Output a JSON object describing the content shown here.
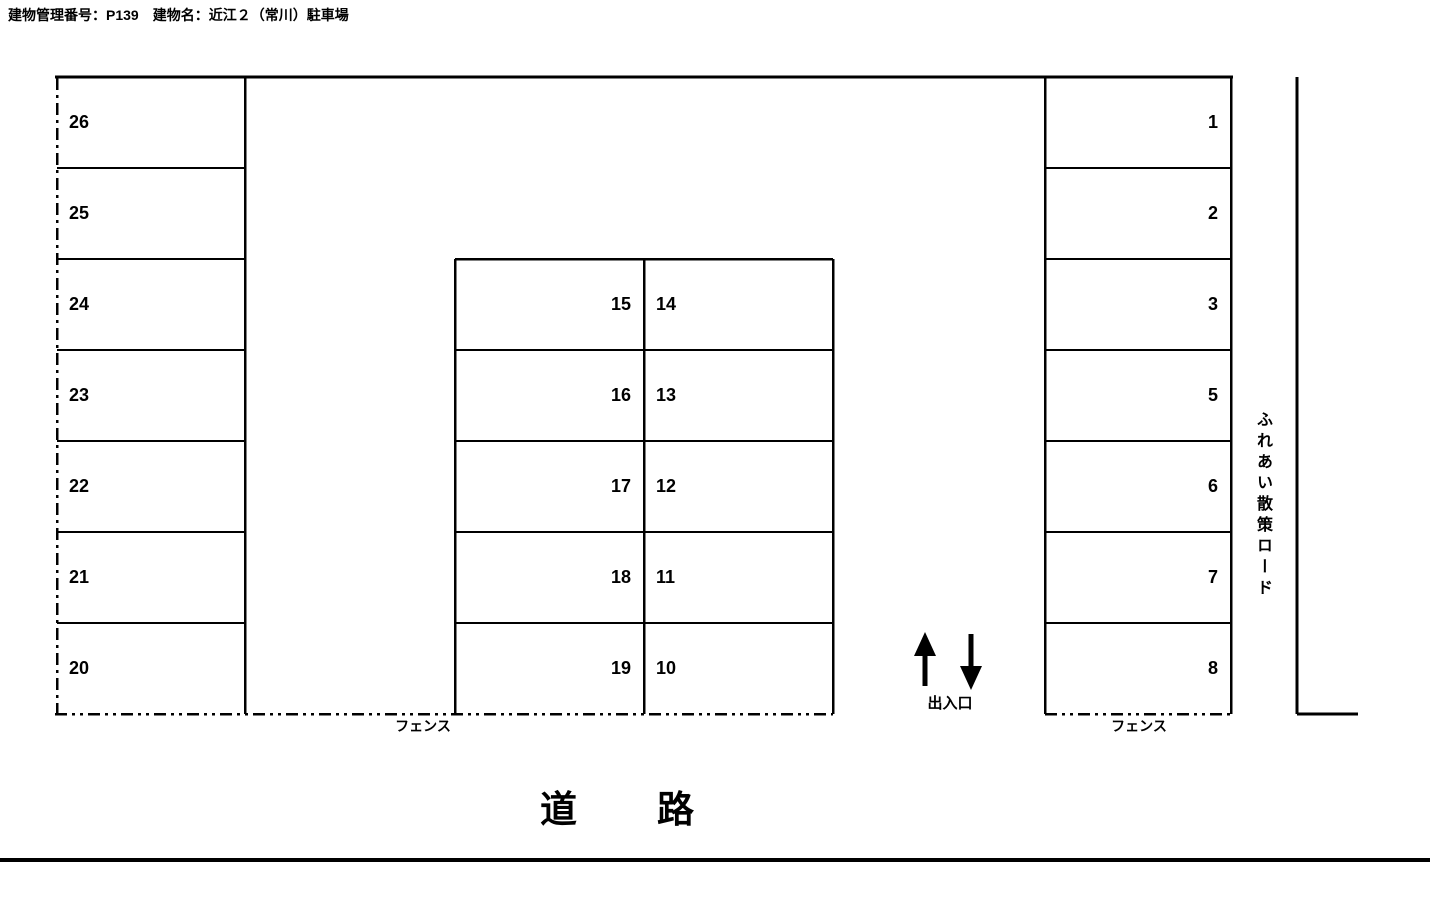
{
  "title": "建物管理番号：P139　建物名：近江２（常川）駐車場",
  "labels": {
    "fence_left": "フェンス",
    "fence_right": "フェンス",
    "entrance": "出入口",
    "road": "道　　路",
    "side_road": "ふれあい散策ロード"
  },
  "icons": {
    "entrance_up": "up-arrow",
    "entrance_down": "down-arrow"
  },
  "colors": {
    "line": "#000000",
    "text": "#000000",
    "background": "#ffffff"
  },
  "parking": {
    "left_column": [
      "26",
      "25",
      "24",
      "23",
      "22",
      "21",
      "20"
    ],
    "middle_left_column": [
      "15",
      "16",
      "17",
      "18",
      "19"
    ],
    "middle_right_column": [
      "14",
      "13",
      "12",
      "11",
      "10"
    ],
    "right_column": [
      "1",
      "2",
      "3",
      "5",
      "6",
      "7",
      "8"
    ]
  }
}
